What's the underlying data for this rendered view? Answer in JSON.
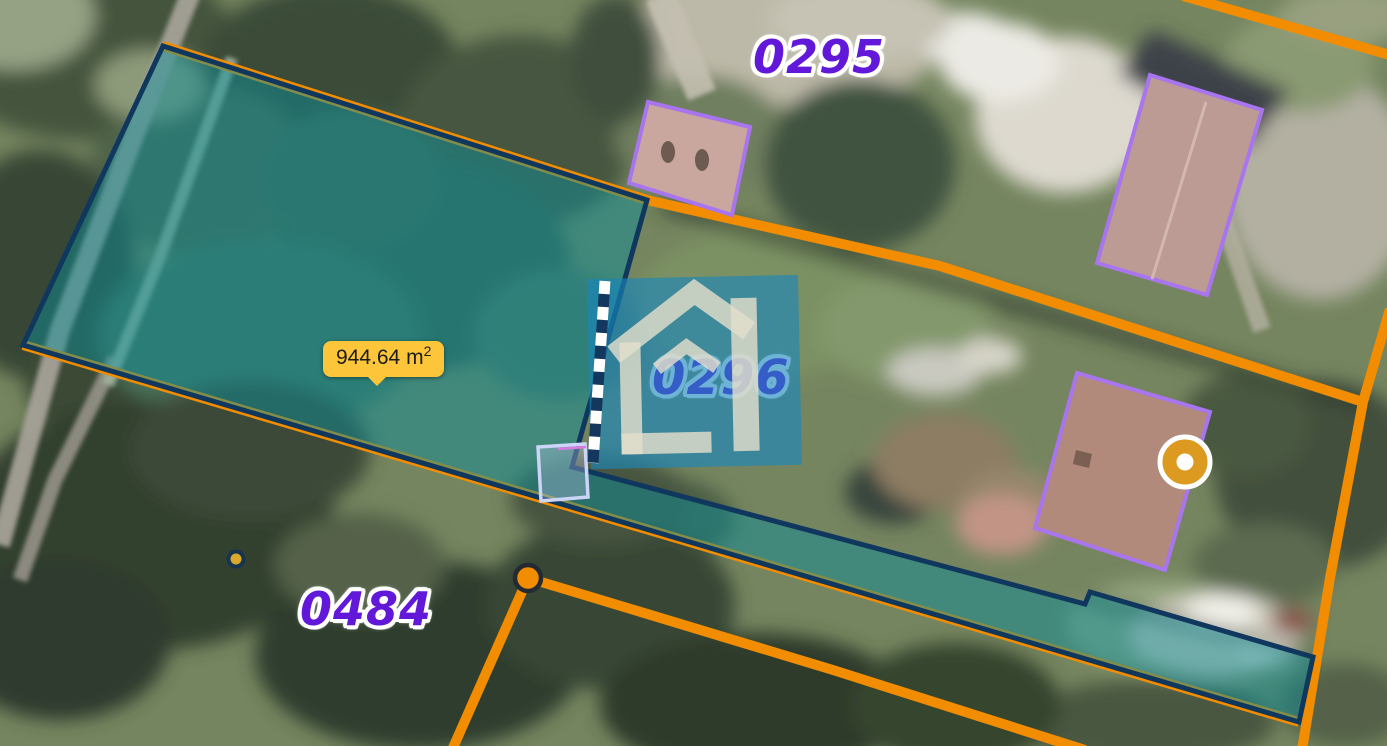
{
  "app": {
    "type": "cadastral-map-viewer"
  },
  "map": {
    "parcel_labels": [
      {
        "text": "0295"
      },
      {
        "text": "0296"
      },
      {
        "text": "0484"
      }
    ],
    "measurement_tooltip": {
      "value": "944.64 m",
      "sup": "2"
    },
    "markers": [
      {
        "name": "position-marker"
      },
      {
        "name": "measure-vertex-dot"
      },
      {
        "name": "survey-point-dot"
      }
    ],
    "icons": [
      "house-watermark-icon"
    ],
    "colors": {
      "boundary_orange": "#F28C00",
      "parcel_border_navy": "#10375E",
      "parcel_fill_teal": "#0A8F9B",
      "label_purple": "#6218D8",
      "tooltip_yellow": "#FCC53A",
      "marker_amber": "#DC9B20",
      "building_outline_purple": "#A875EE",
      "watermark_blue": "#1986BC"
    }
  }
}
